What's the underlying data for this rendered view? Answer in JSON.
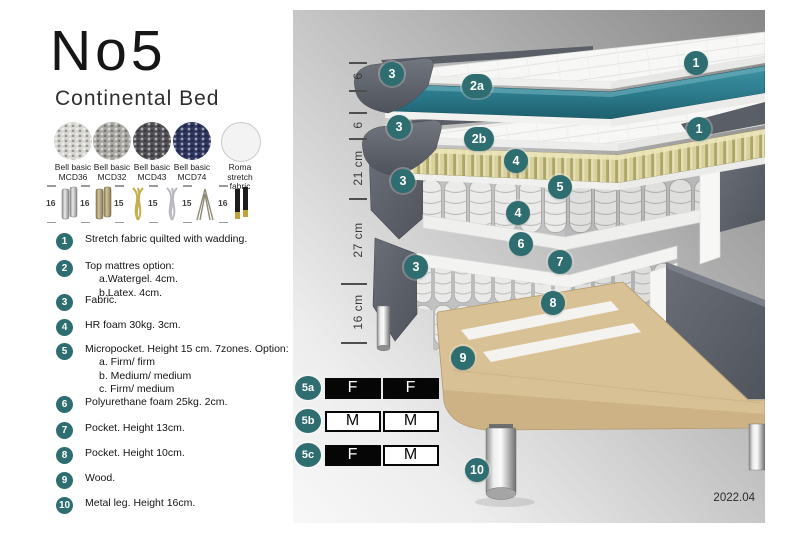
{
  "header": {
    "title": "No5",
    "subtitle": "Continental Bed"
  },
  "swatches": [
    {
      "line1": "Bell basic",
      "line2": "MCD36",
      "color": "#d7d6d1"
    },
    {
      "line1": "Bell basic",
      "line2": "MCD32",
      "color": "#a9a8a3"
    },
    {
      "line1": "Bell basic",
      "line2": "MCD43",
      "color": "#515156"
    },
    {
      "line1": "Bell basic",
      "line2": "MCD74",
      "color": "#2f3760"
    },
    {
      "line1": "Roma",
      "line2": "stretch fabric",
      "color": "#f3f3f3"
    }
  ],
  "legs": [
    {
      "size": "16",
      "type": "chrome-cylinder-leg"
    },
    {
      "size": "16",
      "type": "wood-cylinder-leg"
    },
    {
      "size": "15",
      "type": "gold-twist-leg"
    },
    {
      "size": "15",
      "type": "silver-twist-leg"
    },
    {
      "size": "15",
      "type": "hairpin-leg"
    },
    {
      "size": "16",
      "type": "black-gold-leg"
    }
  ],
  "list": [
    {
      "num": "1",
      "text": "Stretch fabric quilted with wadding.",
      "subs": []
    },
    {
      "num": "2",
      "text": "Top mattres option:",
      "subs": [
        "a.Watergel. 4cm.",
        "b.Latex. 4cm."
      ]
    },
    {
      "num": "3",
      "text": "Fabric.",
      "subs": []
    },
    {
      "num": "4",
      "text": "HR foam 30kg. 3cm.",
      "subs": []
    },
    {
      "num": "5",
      "text": "Micropocket. Height 15 cm. 7zones. Option:",
      "subs": [
        "a. Firm/ firm",
        "b. Medium/ medium",
        "c. Firm/ medium"
      ]
    },
    {
      "num": "6",
      "text": "Polyurethane foam 25kg. 2cm.",
      "subs": []
    },
    {
      "num": "7",
      "text": "Pocket. Height 13cm.",
      "subs": []
    },
    {
      "num": "8",
      "text": "Pocket. Height 10cm.",
      "subs": []
    },
    {
      "num": "9",
      "text": "Wood.",
      "subs": []
    },
    {
      "num": "10",
      "text": "Metal leg. Height 16cm.",
      "subs": []
    }
  ],
  "diagram": {
    "ruler": [
      {
        "label": "6"
      },
      {
        "label": "6"
      },
      {
        "label": "21 cm"
      },
      {
        "label": "27 cm"
      },
      {
        "label": "16 cm"
      }
    ],
    "callouts": [
      {
        "label": "1"
      },
      {
        "label": "3"
      },
      {
        "label": "2a"
      },
      {
        "label": "1"
      },
      {
        "label": "3"
      },
      {
        "label": "2b"
      },
      {
        "label": "4"
      },
      {
        "label": "5"
      },
      {
        "label": "3"
      },
      {
        "label": "4"
      },
      {
        "label": "6"
      },
      {
        "label": "7"
      },
      {
        "label": "3"
      },
      {
        "label": "8"
      },
      {
        "label": "9"
      },
      {
        "label": "10"
      }
    ],
    "firmness": [
      {
        "id": "5a",
        "cells": [
          {
            "letter": "F",
            "fill": "black"
          },
          {
            "letter": "F",
            "fill": "black"
          }
        ]
      },
      {
        "id": "5b",
        "cells": [
          {
            "letter": "M",
            "fill": "white"
          },
          {
            "letter": "M",
            "fill": "white"
          }
        ]
      },
      {
        "id": "5c",
        "cells": [
          {
            "letter": "F",
            "fill": "black"
          },
          {
            "letter": "M",
            "fill": "white"
          }
        ]
      }
    ],
    "version": "2022.04"
  },
  "colors": {
    "accent_teal": "#2f6e70",
    "layer_teal": "#2b7a8b",
    "fabric_gray": "#5a5e67",
    "latex_tan": "#d9d2a2",
    "wood_tan": "#d8c194"
  }
}
